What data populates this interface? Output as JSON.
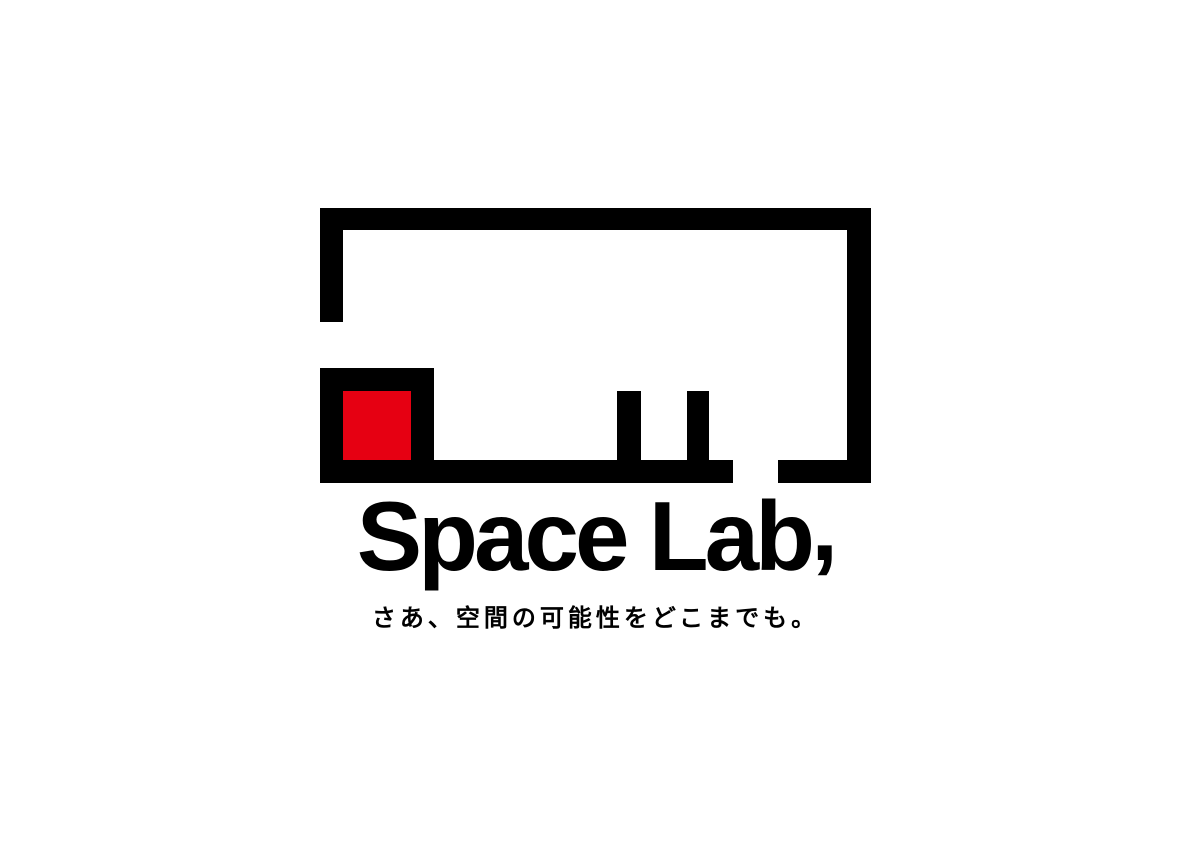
{
  "page": {
    "background_color": "#FFFFFF"
  },
  "logo": {
    "mark": {
      "description": "abstract room floor-plan outline with openings, two interior legs and a red accent square",
      "line_color": "#000000",
      "accent_color": "#E60012"
    },
    "wordmark": {
      "text": "Space Lab",
      "comma": ","
    },
    "tagline": {
      "text": "さあ、空間の可能性をどこまでも。"
    }
  }
}
